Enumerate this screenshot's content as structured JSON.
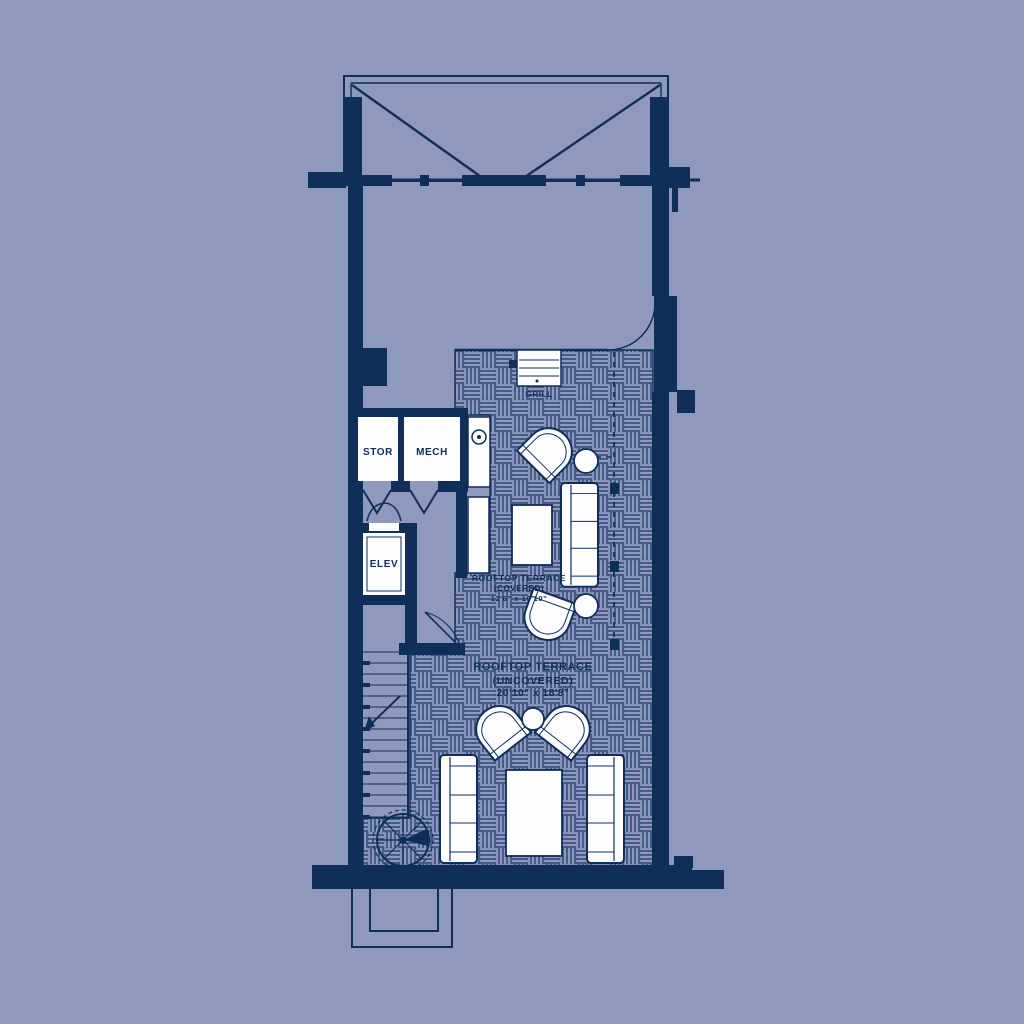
{
  "plan": {
    "title": "Rooftop terrace floor plan",
    "colors": {
      "background": "#8f98bd",
      "line": "#0f2e5a",
      "room_fill": "#fdfdff",
      "hatch_stripe": "#3a5080"
    },
    "labels": {
      "stor": "STOR",
      "mech": "MECH",
      "elev": "ELEV",
      "grill": "GRILL",
      "covered": {
        "name": "ROOFTOP TERRACE",
        "qualifier": "(COVERED)",
        "dimensions": "12'6\" x 19'10\""
      },
      "uncovered": {
        "name": "ROOFTOP TERRACE",
        "qualifier": "(UNCOVERED)",
        "dimensions": "20'10\" x 18'8\""
      }
    }
  }
}
